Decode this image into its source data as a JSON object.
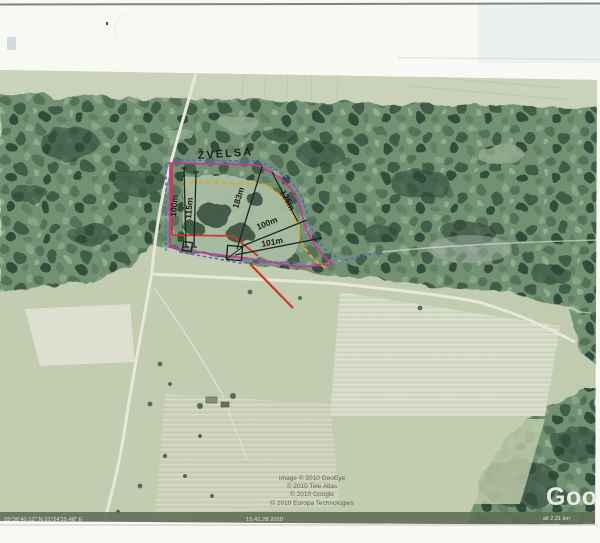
{
  "map": {
    "place_label": "ŽVELSA",
    "measurements": [
      "100m",
      "115m",
      "183m",
      "125m",
      "100m",
      "101m"
    ],
    "attribution": [
      "Image © 2010 GeoEye",
      "© 2010 Tele Atlas",
      "© 2010 Google",
      "© 2010 Europa Technologies"
    ],
    "logo": "Goog",
    "statusbar": {
      "coords": "55°36'40.12\" N  21°24'15.48\" E",
      "date": "15.41.28 2010",
      "eye_alt": "alt 2.31 km"
    }
  }
}
